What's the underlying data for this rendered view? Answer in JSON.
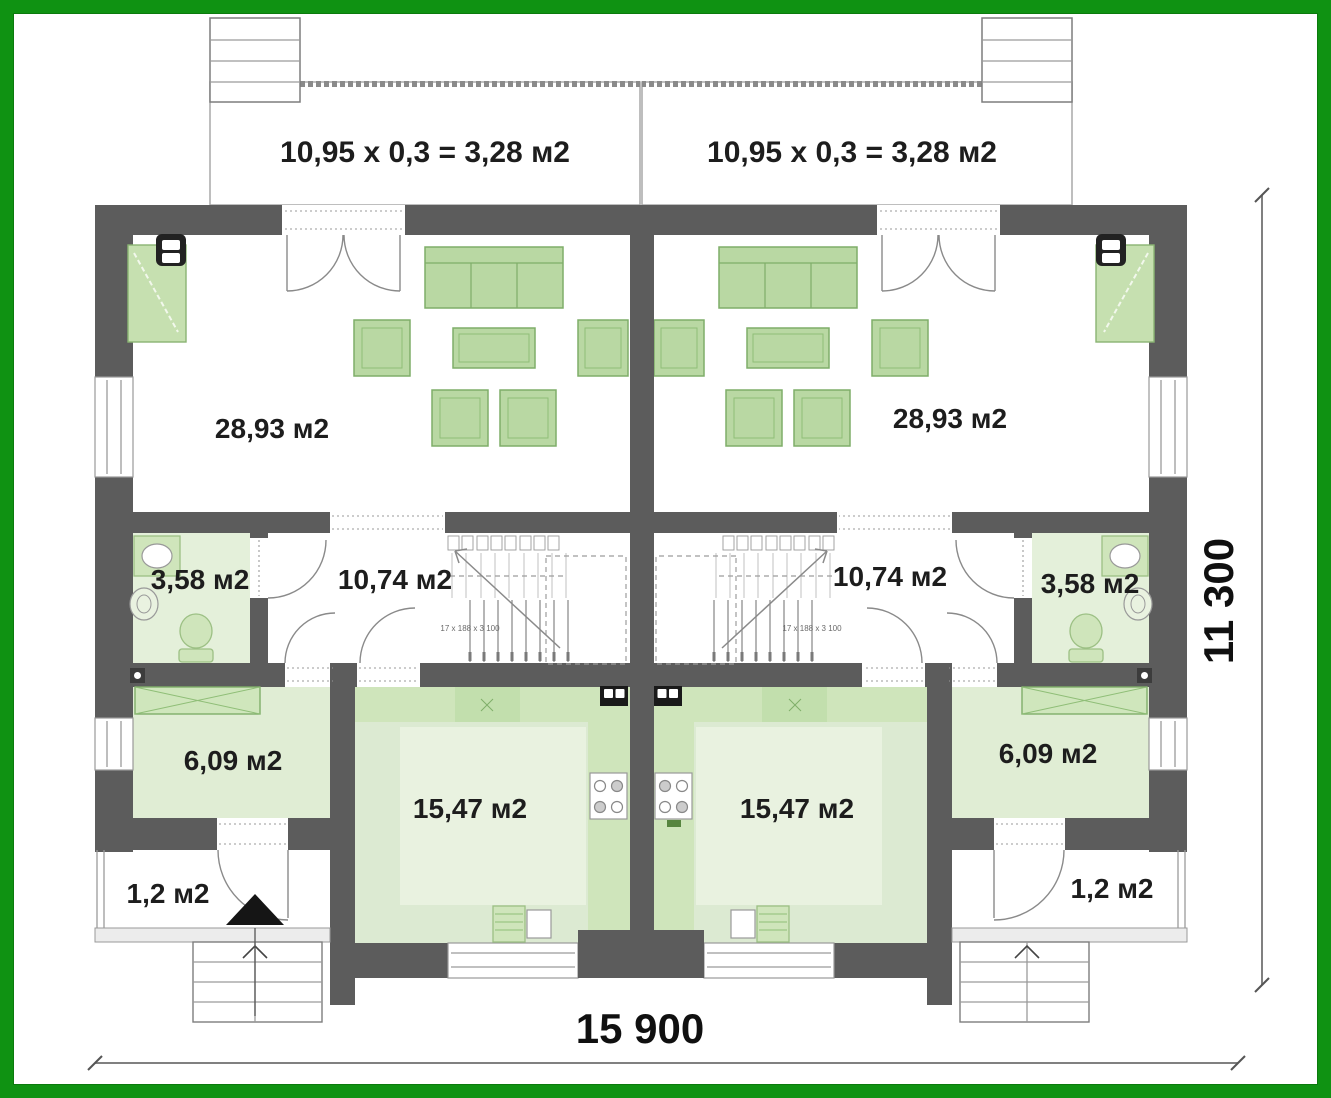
{
  "plan": {
    "type": "duplex-first-floor-plan",
    "frame_color": "#0f9212",
    "wall_color": "#5c5c5c",
    "furniture_color": "#b9d8a3",
    "room_tint_color": "#e0edd4",
    "units": [
      {
        "side": "left",
        "terrace_area": "10,95 x 0,3 = 3,28 м2",
        "living_room_area": "28,93 м2",
        "bathroom_area": "3,58 м2",
        "hall_area": "10,74 м2",
        "bedroom_area": "6,09 м2",
        "kitchen_area": "15,47 м2",
        "entry_area": "1,2 м2",
        "stair_note": "17 x 188 x 3 100"
      },
      {
        "side": "right",
        "terrace_area": "10,95 x 0,3 = 3,28 м2",
        "living_room_area": "28,93 м2",
        "bathroom_area": "3,58 м2",
        "hall_area": "10,74 м2",
        "bedroom_area": "6,09 м2",
        "kitchen_area": "15,47 м2",
        "entry_area": "1,2 м2",
        "stair_note": "17 x 188 x 3 100"
      }
    ],
    "overall_dimensions": {
      "width": "15 900",
      "depth": "11 300"
    }
  }
}
